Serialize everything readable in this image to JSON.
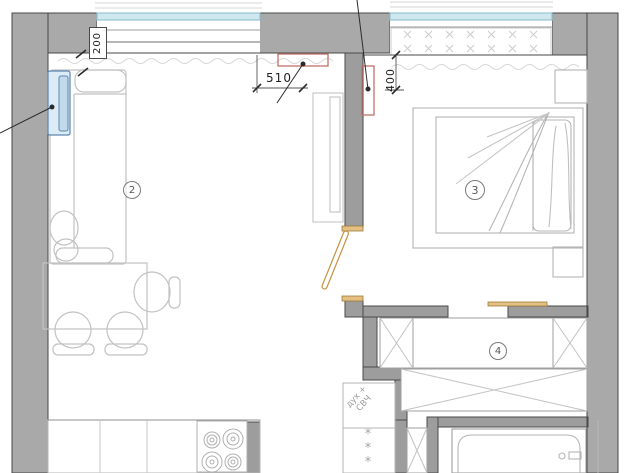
{
  "plan": {
    "room_labels": {
      "living_kitchen": "2",
      "bedroom": "3",
      "hall_wardrobe": "4"
    },
    "dimensions": {
      "d200": "200",
      "d510": "510",
      "d400": "400"
    },
    "notes": {
      "oven_line1": "дух +",
      "oven_line2": "СВЧ"
    },
    "symbols": {
      "freezer_star": "*"
    },
    "colors": {
      "wall_fill": "#a9a9a9",
      "wall_edge": "#474747",
      "furniture_line": "#bdbdbd",
      "window_blue": "#cfe8f0",
      "window_blue_edge": "#86bcca",
      "highlight_blue": "#5b87b0",
      "accent_red": "#c4706a",
      "accent_orange": "#cf9f4e",
      "dimension_ink": "#2b2b2b"
    }
  }
}
